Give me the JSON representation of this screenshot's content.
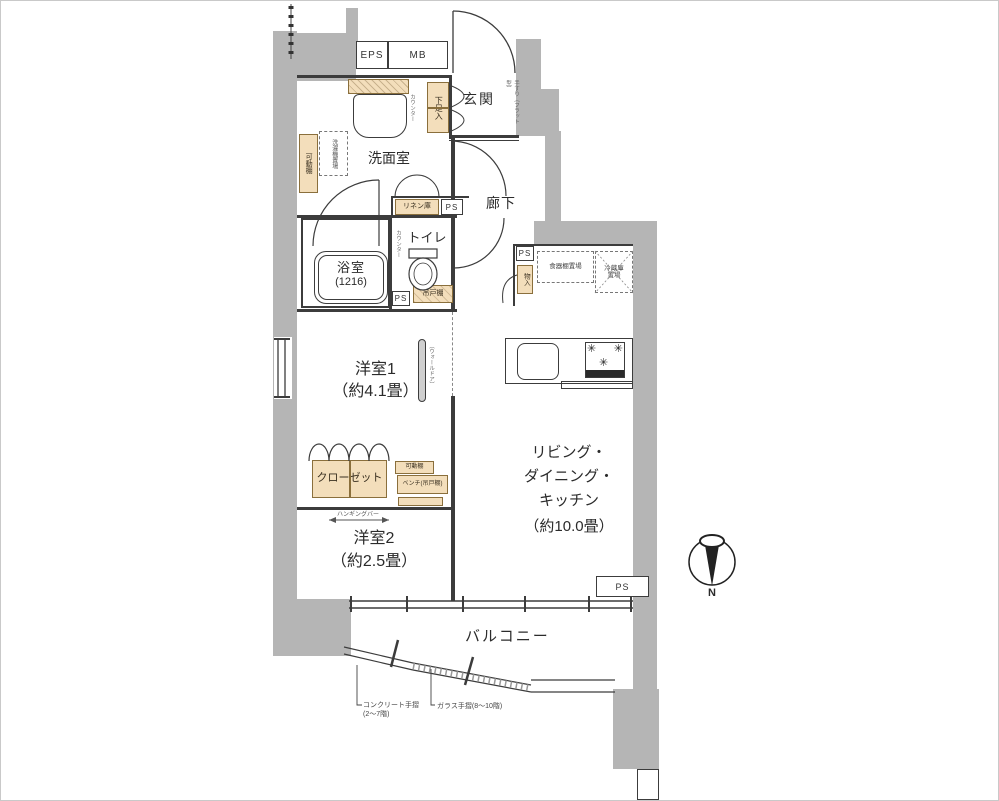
{
  "colors": {
    "wall_fill": "#b5b5b5",
    "line": "#3c3c3c",
    "fixture_fill": "#f3debb",
    "fixture_border": "#8a6f3c"
  },
  "shafts": {
    "eps": "EPS",
    "mb": "MB",
    "ps": "PS"
  },
  "rooms": {
    "genkan": "玄関",
    "senmenshitsu": "洗面室",
    "rouka": "廊下",
    "toilet": "トイレ",
    "bathroom": "浴室",
    "bathroom_size": "(1216)",
    "bedroom1": "洋室1",
    "bedroom1_size": "（約4.1畳）",
    "ldk1": "リビング・",
    "ldk2": "ダイニング・",
    "ldk3": "キッチン",
    "ldk_size": "（約10.0畳）",
    "bedroom2": "洋室2",
    "bedroom2_size": "（約2.5畳）",
    "balcony": "バルコニー",
    "closet": "クローゼット"
  },
  "fixtures": {
    "shoe_cabinet": "下足入",
    "entry_counter": "カウンター",
    "entry_handrail": "手すり（フラット型）",
    "movable_shelf_washroom": "可動棚",
    "washer_space": "洗濯機置場",
    "linen_closet": "リネン庫",
    "toilet_counter": "カウンター",
    "hanging_cupboard": "吊戸棚",
    "storage": "物入",
    "dish_shelf_space": "食器棚置場",
    "fridge_space_1": "冷蔵庫",
    "fridge_space_2": "置場",
    "wall_door": "（ウォールドア）",
    "movable_shelf_closet": "可動棚",
    "bench": "ベンチ(吊戸棚)",
    "hanging_bar": "ハンギングバー"
  },
  "annotations": {
    "concrete_rail_1": "コンクリート手摺",
    "concrete_rail_2": "(2～7階)",
    "glass_rail": "ガラス手摺(8～10階)",
    "north": "N"
  }
}
